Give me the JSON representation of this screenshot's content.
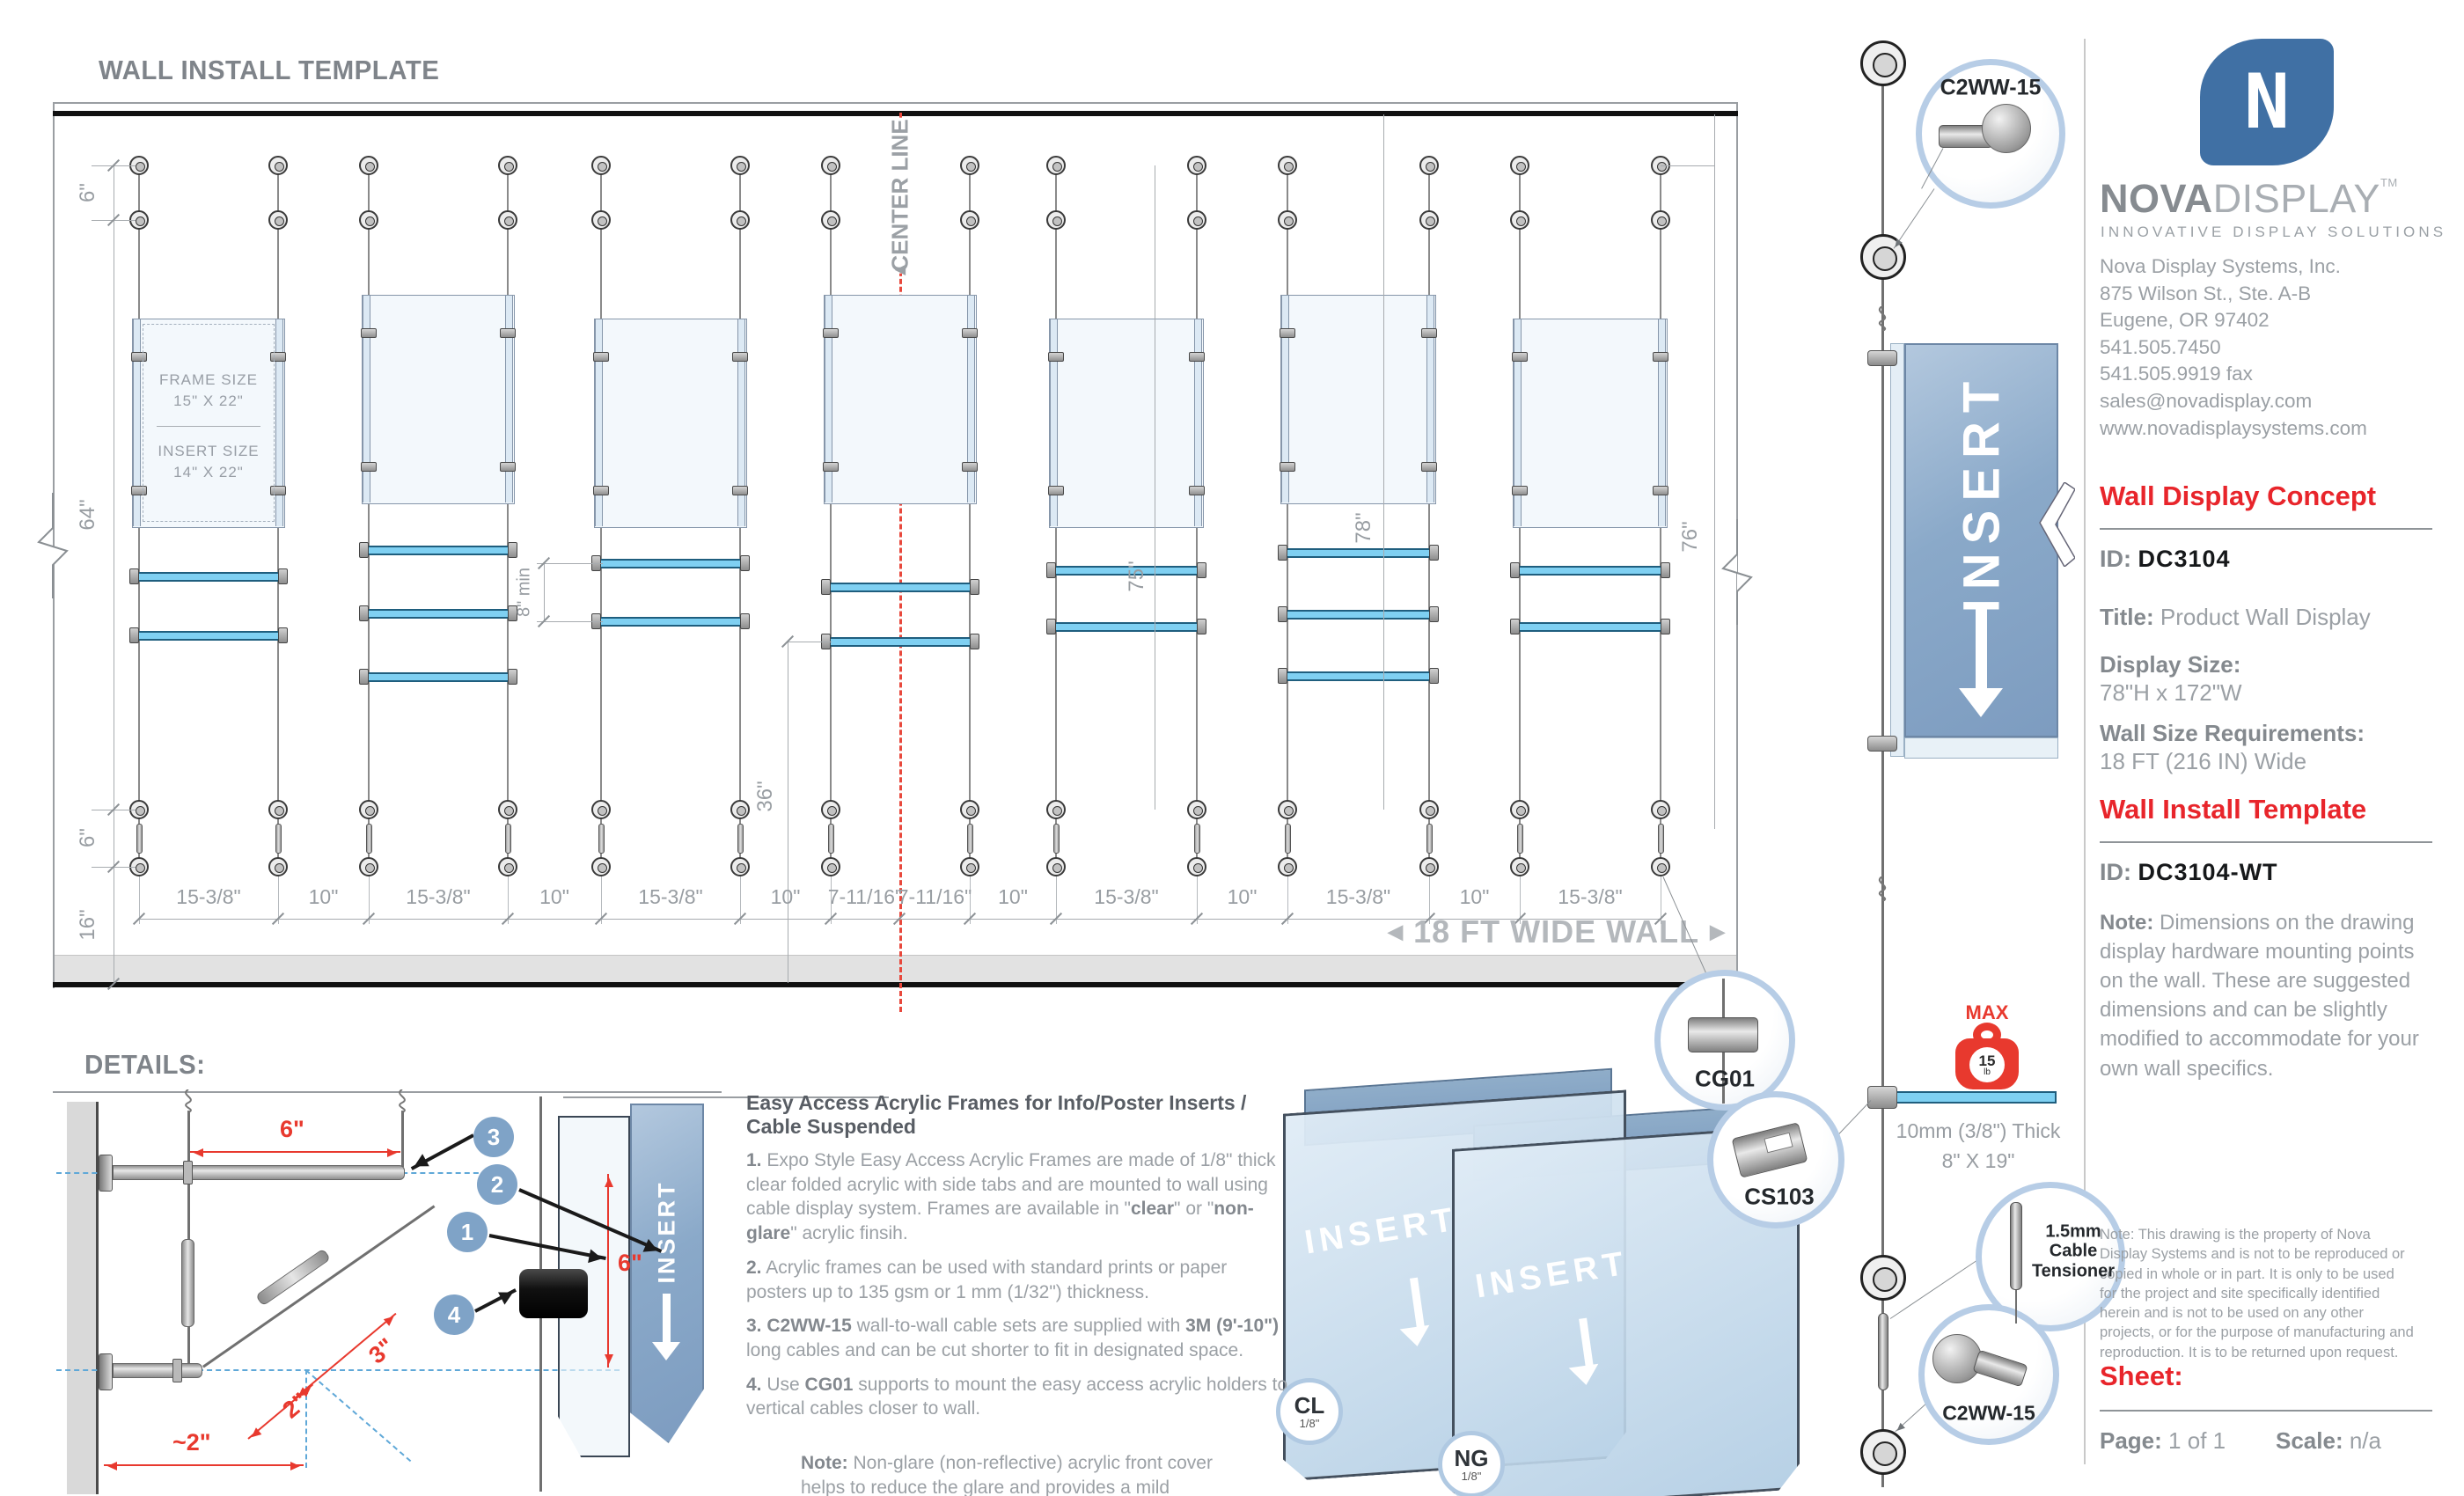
{
  "page": {
    "title": "WALL INSTALL TEMPLATE",
    "details_title": "DETAILS:"
  },
  "drawing": {
    "center_line_label": "CENTER LINE",
    "wide_wall_label": "18 FT WIDE WALL",
    "arrows": {
      "left": "◀",
      "right": "▶",
      "up": "▲"
    },
    "frame_label": {
      "line1": "FRAME SIZE",
      "line2": "15\" X 22\"",
      "line3": "INSERT SIZE",
      "line4": "14\" X 22\""
    },
    "bottom_dims": [
      "15-3/8\"",
      "10\"",
      "15-3/8\"",
      "10\"",
      "15-3/8\"",
      "10\"",
      "7-11/16\"",
      "7-11/16\"",
      "10\"",
      "15-3/8\"",
      "10\"",
      "15-3/8\"",
      "10\"",
      "15-3/8\""
    ],
    "left_dims": {
      "top": "6\"",
      "span": "64\"",
      "bottom": "6\"",
      "floor": "16\""
    },
    "right_dims": {
      "col5": "75\"",
      "col6": "78\"",
      "edge": "76\""
    },
    "mid_dims": {
      "shelf_gap": "8\" min",
      "floor_gap": "36\""
    }
  },
  "details": {
    "dims": {
      "width": "6\"",
      "height": "6\"",
      "diag_upper": "3\"",
      "diag_lower": "2\"",
      "wall_offset": "~2\""
    },
    "badges": [
      "1",
      "2",
      "3",
      "4"
    ]
  },
  "hardware": {
    "c2ww15": "C2WW-15",
    "cg01": "CG01",
    "cs103": "CS103",
    "tensioner": "1.5mm Cable Tensioner",
    "max_label": "MAX",
    "max_value": "15",
    "max_unit": "lb",
    "panel_thickness": "10mm (3/8\") Thick",
    "panel_size": "8\" X 19\"",
    "insert": "INSERT",
    "clear_badge": {
      "code": "CL",
      "size": "1/8\""
    },
    "nonglare_badge": {
      "code": "NG",
      "size": "1/8\""
    }
  },
  "notes": {
    "heading": "Easy Access Acrylic Frames for Info/Poster Inserts / Cable Suspended",
    "items": [
      "**1.** Expo Style Easy Access Acrylic Frames are made of 1/8\" thick clear folded acrylic with side tabs and are mounted to wall using cable display system. Frames are available in \"**clear**\" or \"**non-glare**\" acrylic finsih.",
      "**2.** Acrylic frames can be used with standard prints or paper posters up to 135 gsm or 1 mm (1/32\") thickness.",
      "**3. C2WW-15** wall-to-wall cable sets are supplied with **3M (9'-10\")** long cables and can be cut shorter to fit in designated space.",
      "**4.** Use **CG01** supports to mount the easy access acrylic holders to vertical cables closer to wall."
    ],
    "note": "**Note:** Non-glare (non-reflective) acrylic front cover helps to reduce the glare and provides a mild protection against harmful UV rays."
  },
  "sidebar": {
    "brand": {
      "nova": "NOVA",
      "display": "DISPLAY",
      "tm": "TM",
      "tagline": "INNOVATIVE DISPLAY SOLUTIONS"
    },
    "address": [
      "Nova Display Systems, Inc.",
      "875 Wilson St., Ste. A-B",
      "Eugene, OR 97402",
      "541.505.7450",
      "541.505.9919 fax",
      "sales@novadisplay.com",
      "www.novadisplaysystems.com"
    ],
    "concept": {
      "heading": "Wall Display Concept",
      "id_label": "ID:",
      "id_value": "DC3104",
      "title_label": "Title:",
      "title_value": "Product Wall Display",
      "size_label": "Display Size:",
      "size_value": "78\"H x 172\"W",
      "wall_label": "Wall Size Requirements:",
      "wall_value": "18 FT (216 IN) Wide"
    },
    "install": {
      "heading": "Wall Install Template",
      "id_label": "ID:",
      "id_value": "DC3104-WT",
      "note": "**Note:** Dimensions on the drawing display hardware mounting points on the wall. These are suggested dimensions and can be slightly modified to accommodate for your own wall specifics."
    },
    "fine_print": "Note: This drawing is the property of Nova Display Systems and is not to be reproduced or copied in whole or in part. It is only to be used for the project and site specifically identified herein and is not to be used on any other projects, or for the purpose of manufacturing and reproduction. It is to be returned upon request.",
    "sheet": {
      "heading": "Sheet:",
      "page_label": "Page:",
      "page_value": "1 of 1",
      "scale_label": "Scale:",
      "scale_value": "n/a"
    }
  }
}
